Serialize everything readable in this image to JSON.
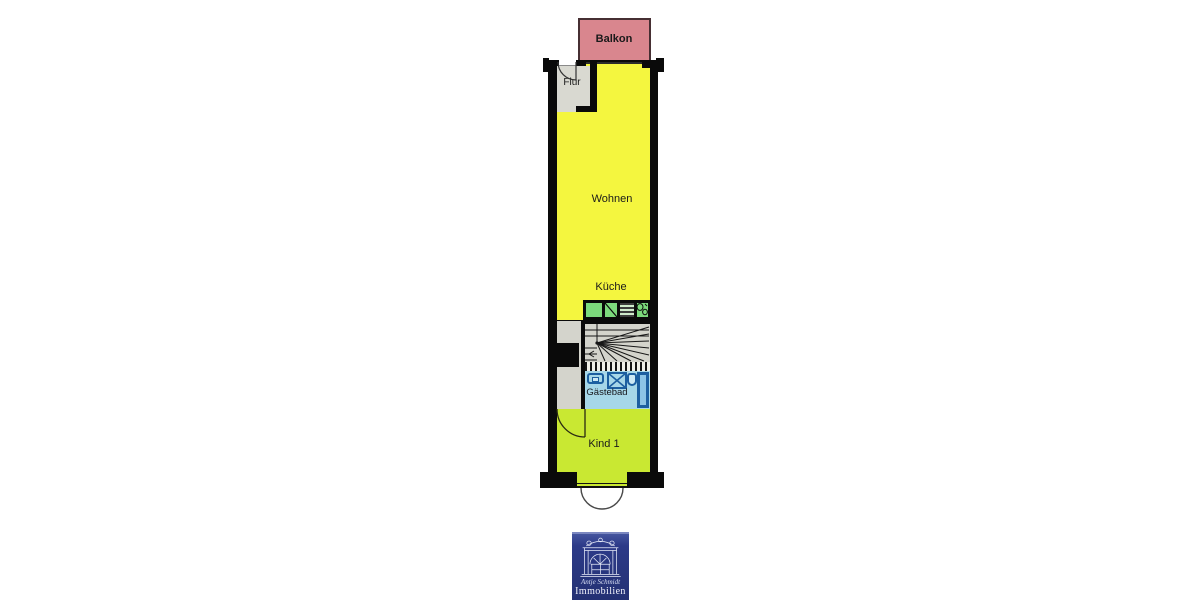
{
  "floorplan": {
    "rooms": {
      "balkon": {
        "label": "Balkon"
      },
      "flur": {
        "label": "Flur"
      },
      "wohnen": {
        "label": "Wohnen"
      },
      "kueche": {
        "label": "Küche"
      },
      "gaestebad": {
        "label": "Gästebad"
      },
      "kind1": {
        "label": "Kind 1"
      }
    },
    "colors": {
      "living_yellow": "#F4F63F",
      "child_green": "#C9E832",
      "balcony_pink": "#D9868E",
      "bath_blue": "#A6D7E8",
      "fixture_blue": "#1C5FA0",
      "kitchen_green": "#7CD97C",
      "floor_gray": "#D4D4CC",
      "wall_black": "#0A0A0A",
      "logo_blue": "#2C3A88"
    }
  },
  "logo": {
    "name": "Antje Schmidt",
    "word": "Immobilien"
  }
}
